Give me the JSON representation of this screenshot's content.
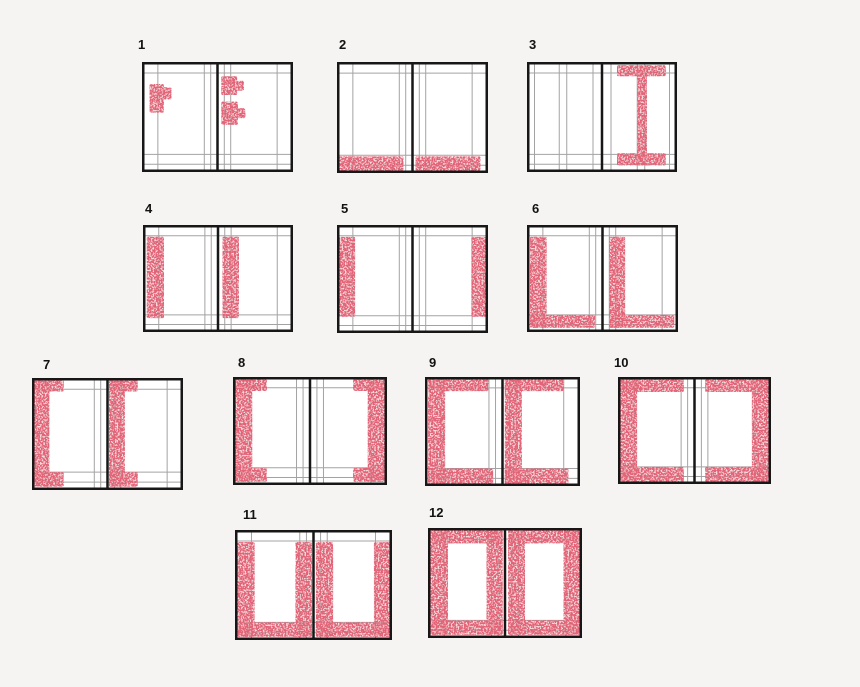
{
  "canvas": {
    "width": 860,
    "height": 687,
    "background": "#f5f4f2"
  },
  "colors": {
    "page_fill": "#ffffff",
    "border": "#171717",
    "spine": "#171717",
    "guide": "#a3a3a3",
    "mark": "#c5303d",
    "mark_base": "#e9aeb2",
    "label": "#121212"
  },
  "layouts": {
    "standard": {
      "v_outer": [
        0.21
      ],
      "v_inner": [
        0.09,
        0.175
      ],
      "h_top": [
        0.1
      ],
      "h_bottom": [
        0.84,
        0.93
      ]
    },
    "two_column": {
      "v_outer": [
        0.1,
        0.43,
        0.53
      ],
      "v_inner": [
        0.12
      ],
      "h_top": [
        0.1
      ],
      "h_bottom": [
        0.84,
        0.93
      ]
    }
  },
  "figures": [
    {
      "id": 1,
      "label": "1",
      "x": 142,
      "y": 62,
      "w": 151,
      "h": 110,
      "lx": 138,
      "ly": 38,
      "layout": "standard",
      "marks": [
        {
          "page": "left",
          "rect": [
            0.1,
            0.2,
            0.29,
            0.46
          ]
        },
        {
          "page": "left",
          "rect": [
            0.28,
            0.23,
            0.39,
            0.34
          ]
        },
        {
          "page": "right",
          "rect": [
            0.05,
            0.13,
            0.26,
            0.3
          ]
        },
        {
          "page": "right",
          "rect": [
            0.25,
            0.17,
            0.35,
            0.26
          ]
        },
        {
          "page": "right",
          "rect": [
            0.05,
            0.36,
            0.27,
            0.57
          ]
        },
        {
          "page": "right",
          "rect": [
            0.26,
            0.42,
            0.37,
            0.51
          ]
        }
      ]
    },
    {
      "id": 2,
      "label": "2",
      "x": 337,
      "y": 62,
      "w": 151,
      "h": 111,
      "lx": 339,
      "ly": 38,
      "layout": "standard",
      "marks": [
        {
          "page": "left",
          "rect": [
            0.02,
            0.85,
            0.88,
            0.98
          ]
        },
        {
          "page": "right",
          "rect": [
            0.04,
            0.85,
            0.9,
            0.98
          ]
        }
      ]
    },
    {
      "id": 3,
      "label": "3",
      "x": 527,
      "y": 62,
      "w": 150,
      "h": 110,
      "lx": 529,
      "ly": 38,
      "layout": "two_column",
      "marks": [
        {
          "page": "right",
          "rect": [
            0.2,
            0.03,
            0.85,
            0.13
          ]
        },
        {
          "page": "right",
          "rect": [
            0.47,
            0.04,
            0.6,
            0.94
          ]
        },
        {
          "page": "right",
          "rect": [
            0.2,
            0.83,
            0.85,
            0.94
          ]
        }
      ]
    },
    {
      "id": 4,
      "label": "4",
      "x": 143,
      "y": 225,
      "w": 150,
      "h": 107,
      "lx": 145,
      "ly": 202,
      "layout": "standard",
      "marks": [
        {
          "page": "left",
          "rect": [
            0.05,
            0.11,
            0.28,
            0.87
          ]
        },
        {
          "page": "right",
          "rect": [
            0.06,
            0.11,
            0.28,
            0.87
          ]
        }
      ]
    },
    {
      "id": 5,
      "label": "5",
      "x": 337,
      "y": 225,
      "w": 151,
      "h": 108,
      "lx": 341,
      "ly": 202,
      "layout": "standard",
      "marks": [
        {
          "page": "left",
          "rect": [
            0.03,
            0.11,
            0.24,
            0.85
          ]
        },
        {
          "page": "right",
          "rect": [
            0.78,
            0.11,
            0.98,
            0.85
          ]
        }
      ]
    },
    {
      "id": 6,
      "label": "6",
      "x": 527,
      "y": 225,
      "w": 151,
      "h": 107,
      "lx": 532,
      "ly": 202,
      "layout": "standard",
      "marks": [
        {
          "page": "left",
          "rect": [
            0.04,
            0.11,
            0.26,
            0.96
          ]
        },
        {
          "page": "left",
          "rect": [
            0.04,
            0.84,
            0.9,
            0.96
          ]
        },
        {
          "page": "right",
          "rect": [
            0.09,
            0.11,
            0.3,
            0.96
          ]
        },
        {
          "page": "right",
          "rect": [
            0.09,
            0.84,
            0.95,
            0.96
          ]
        }
      ]
    },
    {
      "id": 7,
      "label": "7",
      "x": 32,
      "y": 378,
      "w": 151,
      "h": 112,
      "lx": 43,
      "ly": 358,
      "layout": "standard",
      "marks": [
        {
          "page": "left",
          "rect": [
            0.02,
            0.02,
            0.42,
            0.12
          ]
        },
        {
          "page": "left",
          "rect": [
            0.02,
            0.02,
            0.23,
            0.97
          ]
        },
        {
          "page": "left",
          "rect": [
            0.02,
            0.84,
            0.42,
            0.97
          ]
        },
        {
          "page": "right",
          "rect": [
            0.02,
            0.02,
            0.4,
            0.12
          ]
        },
        {
          "page": "right",
          "rect": [
            0.02,
            0.02,
            0.23,
            0.97
          ]
        },
        {
          "page": "right",
          "rect": [
            0.02,
            0.84,
            0.4,
            0.97
          ]
        }
      ]
    },
    {
      "id": 8,
      "label": "8",
      "x": 233,
      "y": 377,
      "w": 154,
      "h": 108,
      "lx": 238,
      "ly": 356,
      "layout": "standard",
      "marks": [
        {
          "page": "left",
          "rect": [
            0.03,
            0.02,
            0.44,
            0.13
          ]
        },
        {
          "page": "left",
          "rect": [
            0.03,
            0.02,
            0.25,
            0.97
          ]
        },
        {
          "page": "left",
          "rect": [
            0.03,
            0.84,
            0.44,
            0.97
          ]
        },
        {
          "page": "right",
          "rect": [
            0.56,
            0.02,
            0.97,
            0.13
          ]
        },
        {
          "page": "right",
          "rect": [
            0.75,
            0.02,
            0.97,
            0.97
          ]
        },
        {
          "page": "right",
          "rect": [
            0.56,
            0.84,
            0.97,
            0.97
          ]
        }
      ]
    },
    {
      "id": 9,
      "label": "9",
      "x": 425,
      "y": 377,
      "w": 155,
      "h": 109,
      "lx": 429,
      "ly": 356,
      "layout": "standard",
      "marks": [
        {
          "page": "left",
          "rect": [
            0.04,
            0.01,
            0.82,
            0.13
          ]
        },
        {
          "page": "left",
          "rect": [
            0.04,
            0.01,
            0.26,
            0.98
          ]
        },
        {
          "page": "left",
          "rect": [
            0.04,
            0.84,
            0.88,
            0.98
          ]
        },
        {
          "page": "right",
          "rect": [
            0.03,
            0.01,
            0.79,
            0.13
          ]
        },
        {
          "page": "right",
          "rect": [
            0.03,
            0.01,
            0.25,
            0.98
          ]
        },
        {
          "page": "right",
          "rect": [
            0.03,
            0.84,
            0.85,
            0.98
          ]
        }
      ]
    },
    {
      "id": 10,
      "label": "10",
      "x": 618,
      "y": 377,
      "w": 153,
      "h": 107,
      "lx": 614,
      "ly": 356,
      "layout": "standard",
      "marks": [
        {
          "page": "left",
          "rect": [
            0.03,
            0.02,
            0.86,
            0.14
          ]
        },
        {
          "page": "left",
          "rect": [
            0.03,
            0.02,
            0.25,
            0.98
          ]
        },
        {
          "page": "left",
          "rect": [
            0.03,
            0.84,
            0.86,
            0.98
          ]
        },
        {
          "page": "right",
          "rect": [
            0.14,
            0.02,
            0.97,
            0.14
          ]
        },
        {
          "page": "right",
          "rect": [
            0.75,
            0.02,
            0.97,
            0.98
          ]
        },
        {
          "page": "right",
          "rect": [
            0.14,
            0.84,
            0.97,
            0.98
          ]
        }
      ]
    },
    {
      "id": 11,
      "label": "11",
      "x": 235,
      "y": 530,
      "w": 157,
      "h": 110,
      "lx": 243,
      "ly": 508,
      "layout": "standard",
      "marks": [
        {
          "page": "left",
          "rect": [
            0.03,
            0.11,
            0.25,
            0.97
          ]
        },
        {
          "page": "left",
          "rect": [
            0.77,
            0.11,
            0.98,
            0.97
          ]
        },
        {
          "page": "left",
          "rect": [
            0.03,
            0.84,
            0.98,
            0.97
          ]
        },
        {
          "page": "right",
          "rect": [
            0.03,
            0.11,
            0.25,
            0.97
          ]
        },
        {
          "page": "right",
          "rect": [
            0.77,
            0.11,
            0.98,
            0.97
          ]
        },
        {
          "page": "right",
          "rect": [
            0.03,
            0.84,
            0.98,
            0.97
          ]
        }
      ]
    },
    {
      "id": 12,
      "label": "12",
      "x": 428,
      "y": 528,
      "w": 154,
      "h": 110,
      "lx": 429,
      "ly": 506,
      "layout": "standard",
      "marks": [
        {
          "page": "left",
          "rect": [
            0.03,
            0.02,
            0.97,
            0.14
          ]
        },
        {
          "page": "left",
          "rect": [
            0.03,
            0.02,
            0.26,
            0.97
          ]
        },
        {
          "page": "left",
          "rect": [
            0.76,
            0.02,
            0.97,
            0.97
          ]
        },
        {
          "page": "left",
          "rect": [
            0.03,
            0.84,
            0.97,
            0.97
          ]
        },
        {
          "page": "right",
          "rect": [
            0.04,
            0.02,
            0.97,
            0.14
          ]
        },
        {
          "page": "right",
          "rect": [
            0.04,
            0.02,
            0.26,
            0.97
          ]
        },
        {
          "page": "right",
          "rect": [
            0.76,
            0.02,
            0.97,
            0.97
          ]
        },
        {
          "page": "right",
          "rect": [
            0.04,
            0.84,
            0.97,
            0.97
          ]
        }
      ]
    }
  ]
}
